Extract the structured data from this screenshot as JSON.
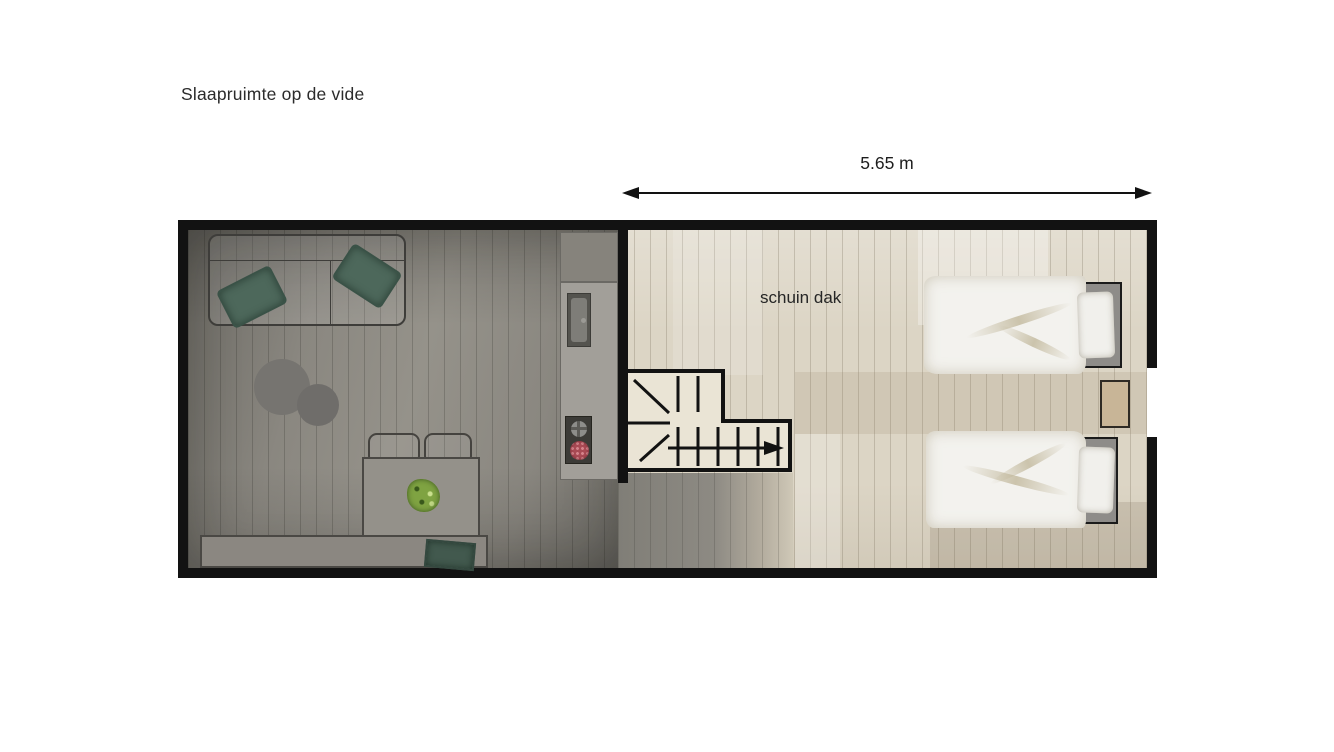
{
  "labels": {
    "title": "Slaapruimte op de vide",
    "dimension": "5.65 m",
    "roof_note": "schuin dak"
  },
  "colors": {
    "wall": "#121212",
    "line-dark": "#4a4844",
    "floor-light": "#dcd5c5",
    "stair-fill": "#eae4d5",
    "pillow-green": "#4d685b",
    "cushion-green": "#42594e",
    "bed-frame": "#8e8c89",
    "duvet": "#f3f2ee",
    "nightstand": "#c8b597",
    "burner-red": "#a84a54",
    "plant-green": "#7fa342",
    "table-fill": "#94918a"
  }
}
